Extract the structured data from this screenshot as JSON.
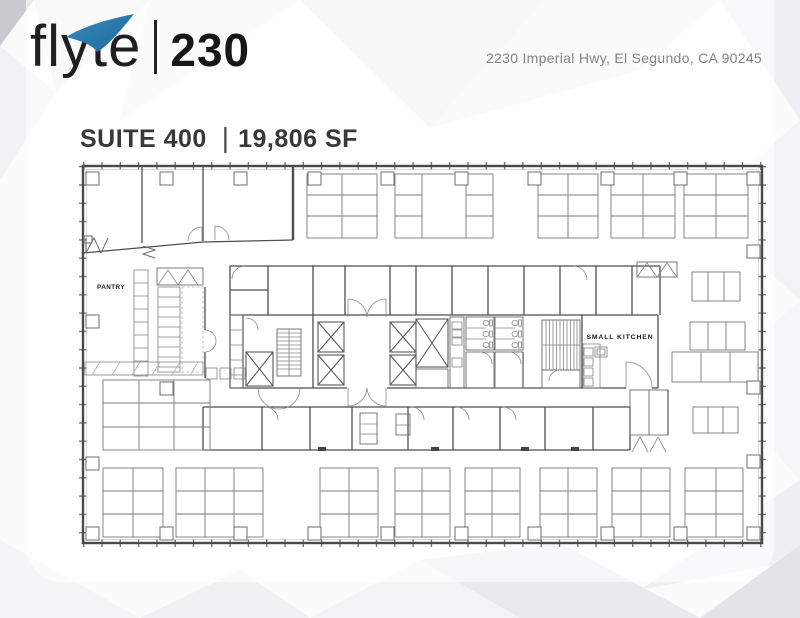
{
  "brand": {
    "name": "flyte",
    "suite_number": "230",
    "logo_icon": "swoosh-icon"
  },
  "header": {
    "address": "2230 Imperial Hwy, El Segundo, CA 90245"
  },
  "title": {
    "suite": "SUITE 400",
    "separator": "|",
    "area": "19,806 SF"
  },
  "floor_plan": {
    "labels": {
      "pantry": "PANTRY",
      "small_kitchen": "SMALL KITCHEN"
    }
  },
  "colors": {
    "logo_blue": "#2e80b2",
    "logo_text": "#1f1f1f",
    "address_gray": "#848484",
    "title_gray": "#383838",
    "plan_line": "#4d4d4d"
  }
}
